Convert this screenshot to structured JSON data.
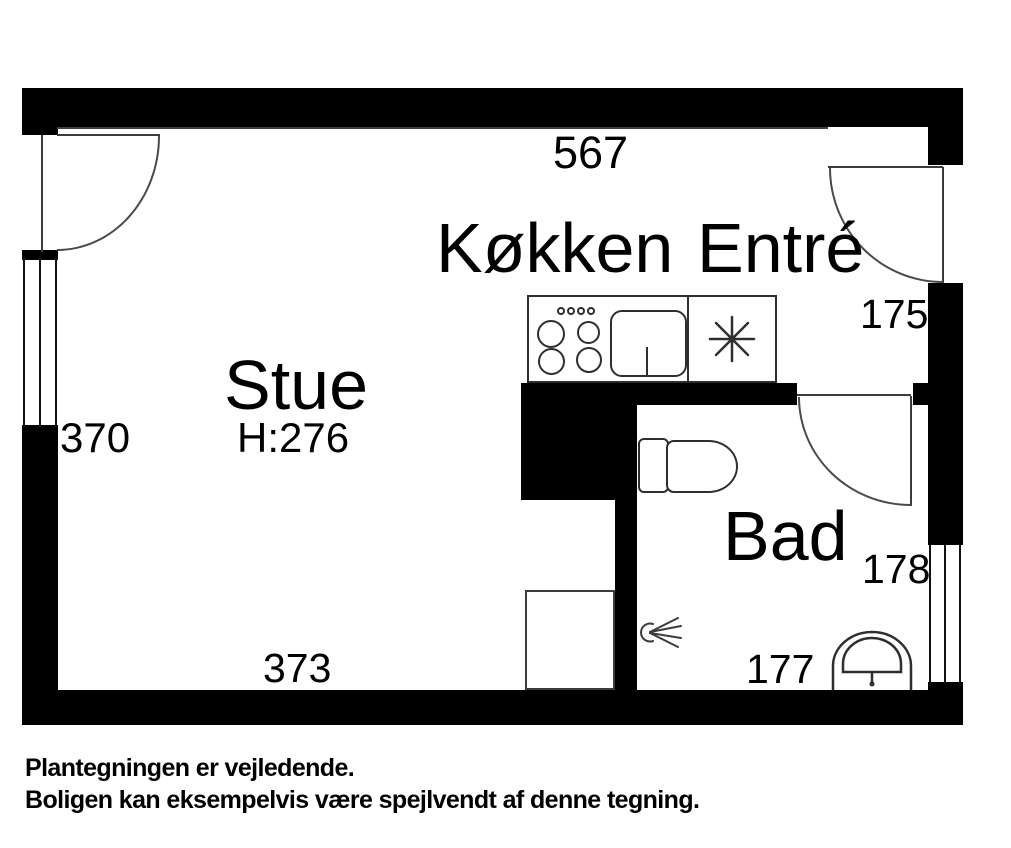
{
  "plan": {
    "rooms": {
      "stue": {
        "name": "Stue",
        "height": "H:276"
      },
      "koekken": {
        "name": "Køkken"
      },
      "entre": {
        "name": "Entré"
      },
      "bad": {
        "name": "Bad"
      }
    },
    "dimensions": {
      "top_width": "567",
      "left_height": "370",
      "bottom_width": "373",
      "entre_width": "175",
      "bad_height": "178",
      "bad_width": "177"
    },
    "fixtures": [
      "stove",
      "sink",
      "refrigerator-asterisk",
      "toilet",
      "shower",
      "washbasin",
      "cabinet"
    ],
    "colors": {
      "wall": "#000000",
      "line": "#3c3c3c",
      "background": "#ffffff"
    }
  },
  "note": {
    "line1": "Plantegningen er vejledende.",
    "line2": "Boligen kan eksempelvis være spejlvendt af denne tegning."
  }
}
